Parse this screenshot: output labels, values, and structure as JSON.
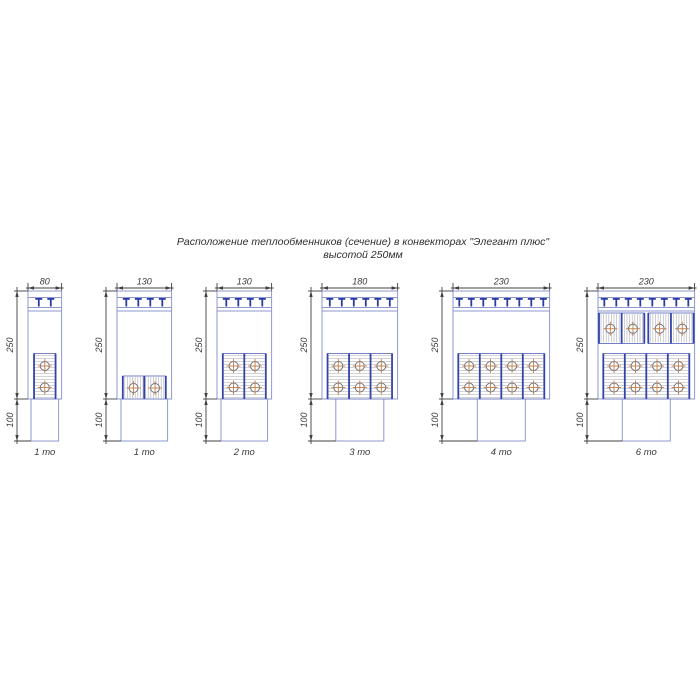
{
  "title": {
    "line1": "Расположение теплообменников (сечение) в конвекторах \"Элегант плюс\"",
    "line2": "высотой 250мм"
  },
  "colors": {
    "outline": "#8e99d2",
    "grille_teeth": "#2c3ca4",
    "divider": "#3443a9",
    "hx_border": "#7580c6",
    "hatch": "#b9b9c0",
    "tube_outline": "#70707a",
    "tube_cross": "#c07c46",
    "dimension": "#404040"
  },
  "convectors": [
    {
      "width_label": "80",
      "height_label": "250",
      "duct_label": "100",
      "caption": "1 то",
      "width_mm": 80,
      "grille_teeth": 2,
      "exchangers": {
        "bottom": {
          "blocks": 1,
          "cells_per_block": 1,
          "tube_rows": 2,
          "hatch": "horizontal",
          "flat": false
        }
      }
    },
    {
      "width_label": "130",
      "height_label": "250",
      "duct_label": "100",
      "caption": "1 то",
      "width_mm": 130,
      "grille_teeth": 4,
      "exchangers": {
        "bottom": {
          "blocks": 1,
          "cells_per_block": 2,
          "tube_rows": 1,
          "hatch": "vertical",
          "flat": true
        }
      }
    },
    {
      "width_label": "130",
      "height_label": "250",
      "duct_label": "100",
      "caption": "2 то",
      "width_mm": 130,
      "grille_teeth": 4,
      "exchangers": {
        "bottom": {
          "blocks": 2,
          "cells_per_block": 1,
          "tube_rows": 2,
          "hatch": "horizontal",
          "flat": false
        }
      }
    },
    {
      "width_label": "180",
      "height_label": "250",
      "duct_label": "100",
      "caption": "3 то",
      "width_mm": 180,
      "grille_teeth": 6,
      "exchangers": {
        "bottom": {
          "blocks": 3,
          "cells_per_block": 1,
          "tube_rows": 2,
          "hatch": "horizontal",
          "flat": false
        }
      }
    },
    {
      "width_label": "230",
      "height_label": "250",
      "duct_label": "100",
      "caption": "4 то",
      "width_mm": 230,
      "grille_teeth": 8,
      "exchangers": {
        "bottom": {
          "blocks": 4,
          "cells_per_block": 1,
          "tube_rows": 2,
          "hatch": "horizontal",
          "flat": false
        }
      }
    },
    {
      "width_label": "230",
      "height_label": "250",
      "duct_label": "100",
      "caption": "6 то",
      "width_mm": 230,
      "grille_teeth": 8,
      "exchangers": {
        "bottom": {
          "blocks": 4,
          "cells_per_block": 1,
          "tube_rows": 2,
          "hatch": "horizontal",
          "flat": false
        },
        "top": {
          "blocks": 2,
          "cells_per_block": 2,
          "tube_rows": 1,
          "hatch": "vertical"
        }
      }
    }
  ]
}
